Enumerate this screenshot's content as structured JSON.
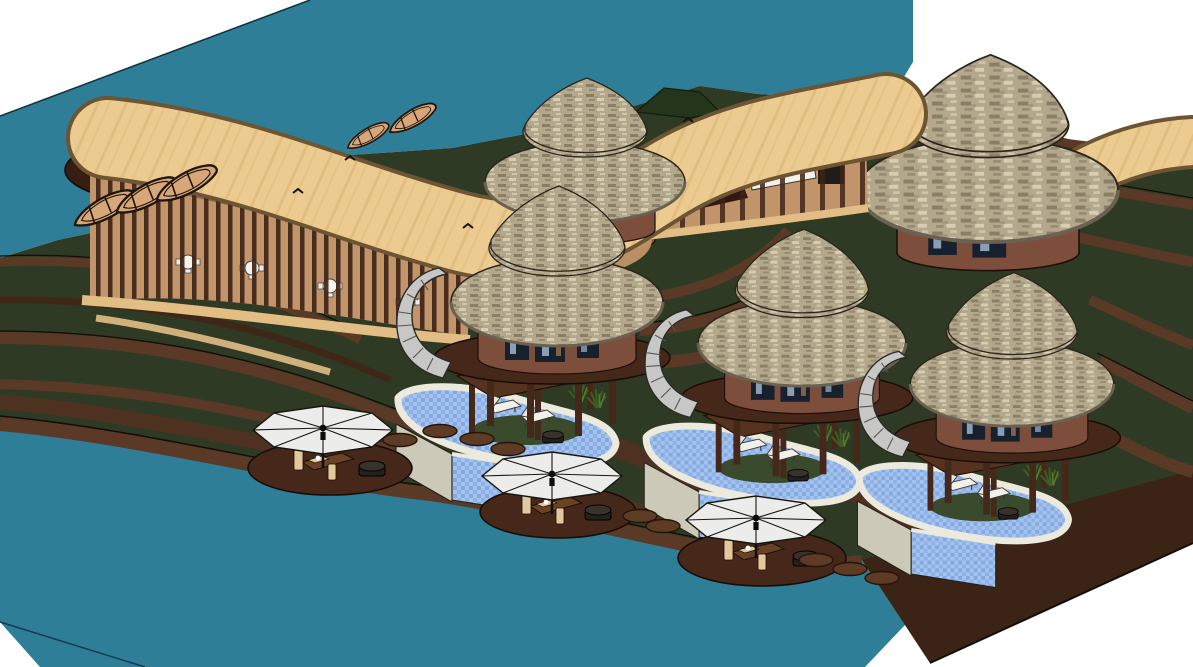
{
  "scene": {
    "label": "3D axonometric render of a tropical resort: curved slat pavilion, five thatched villas with plunge pools, beach umbrella decks, rowboats and terraced lawns beside teal water",
    "type": "3d-architectural-render",
    "inventory": {
      "water_body": "lake-lagoon",
      "rowboats_on_shore": 3,
      "rowboats_at_dock": 2,
      "curved_pavilion": 1,
      "thatched_back_huts": 2,
      "thatched_villas": 3,
      "villa_plunge_pools": 3,
      "umbrella_lounge_decks": 3,
      "spiral_stairs": 3,
      "stepping_stone_clusters": 3,
      "terraced_lawns": "left, center and right"
    }
  },
  "colors": {
    "white": "#ffffff",
    "water": "#2f7e97",
    "water_line": "#123c4e",
    "grass": "#2f3a24",
    "grass2": "#3a4a2c",
    "hill": "#24351c",
    "terr_brown": "#5a3a26",
    "terr_dark": "#3f2718",
    "face_brown": "#3b2416",
    "deck": "#46281a",
    "slat": "#3e2417",
    "woodfloor": "#c1946a",
    "rim": "#e2be85",
    "roof_tan": "#ebcb8f",
    "roof_stripe": "#d8b373",
    "roof_out": "#6d5433",
    "thatch_base": "#b3a88c",
    "thatch_dark": "#8a7e66",
    "thatch_light": "#d6cdb2",
    "thatch_line": "#2b241a",
    "hut_wall": "#7e4e3d",
    "win": "#17212e",
    "glass": "#9eb5cf",
    "coping": "#ece9dd",
    "pool_blue": "#a4c4ef",
    "pool_blue2": "#7fa3dc",
    "wall_gray": "#cdc9b8",
    "umbrella": "#ececea",
    "stair": "#c7c7c5",
    "bench": "#6b4226",
    "cushion": "#e3c89e",
    "tub": "#24201a",
    "boat": "#d7a77a",
    "plant": "#3f5c22",
    "ink": "#140c06",
    "accent_red": "#c23b22",
    "accent_blue": "#2c4fa3",
    "accent_yellow": "#e8b10f"
  }
}
